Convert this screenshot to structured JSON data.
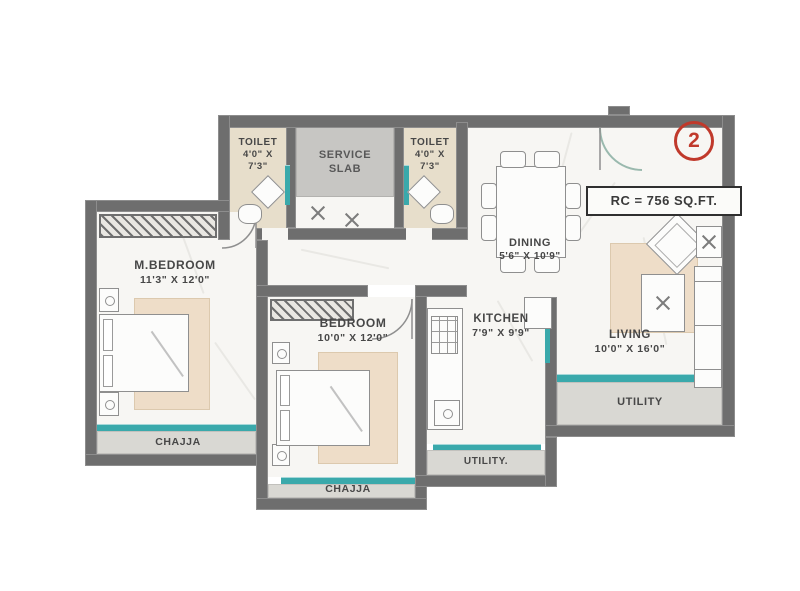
{
  "floorplan": {
    "unit_badge": "2",
    "area_label": "RC = 756 SQ.FT.",
    "rooms": {
      "toilet_left": {
        "name": "TOILET",
        "dim1": "4'0\" X",
        "dim2": "7'3\""
      },
      "service_slab": {
        "line1": "SERVICE",
        "line2": "SLAB"
      },
      "toilet_right": {
        "name": "TOILET",
        "dim1": "4'0\" X",
        "dim2": "7'3\""
      },
      "dining": {
        "name": "DINING",
        "dim": "5'6\" X 10'9\""
      },
      "m_bedroom": {
        "name": "M.BEDROOM",
        "dim": "11'3\" X 12'0\""
      },
      "bedroom": {
        "name": "BEDROOM",
        "dim": "10'0\" X 12'0\""
      },
      "kitchen": {
        "name": "KITCHEN",
        "dim": "7'9\" X 9'9\""
      },
      "living": {
        "name": "LIVING",
        "dim": "10'0\" X 16'0\""
      },
      "utility_living": {
        "name": "UTILITY"
      },
      "utility_kitchen": {
        "name": "UTILITY."
      },
      "chajja_master": {
        "name": "CHAJJA"
      },
      "chajja_bedroom": {
        "name": "CHAJJA"
      }
    },
    "colors": {
      "wall": "#6e6e6e",
      "window_teal": "#3aa9ab",
      "toilet_floor": "#e7decb",
      "service_floor": "#c7c6c3",
      "balcony_floor": "#d9d8d3",
      "rug": "#eeddc8",
      "label_text": "#474747",
      "unit_badge_red": "#c0392b"
    }
  }
}
